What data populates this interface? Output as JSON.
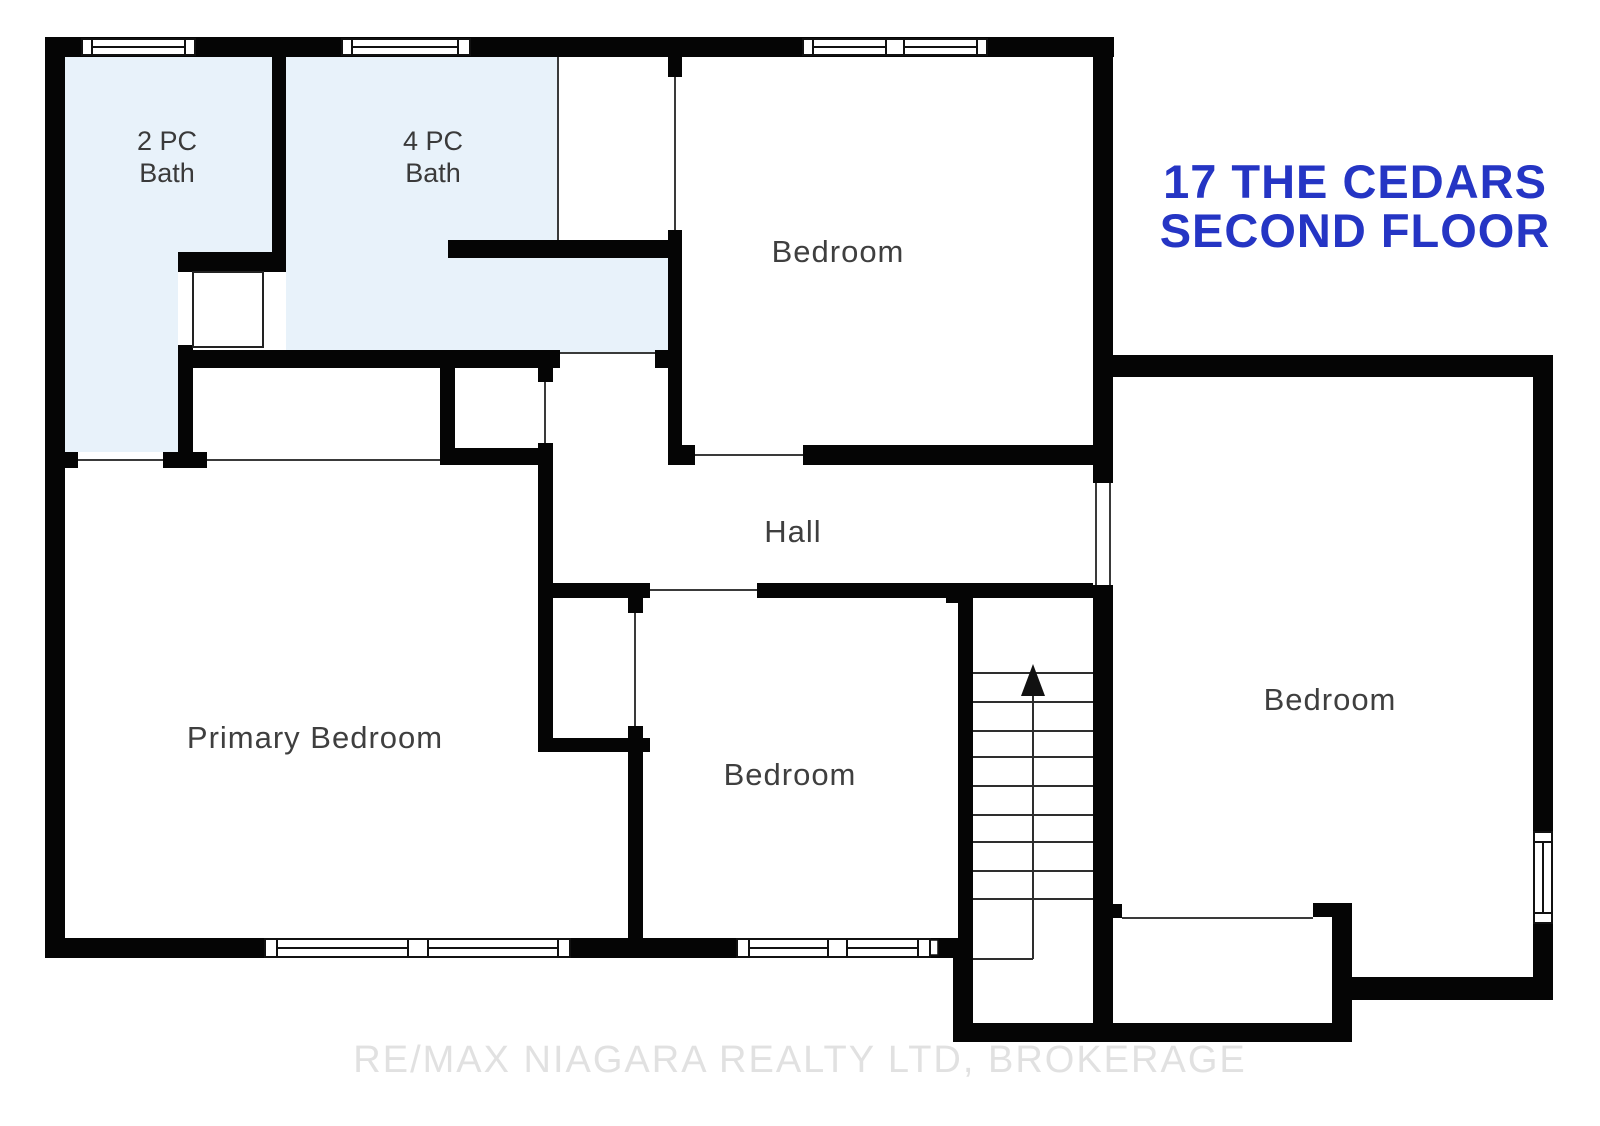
{
  "title": {
    "line1": "17 THE CEDARS",
    "line2": "SECOND FLOOR"
  },
  "watermark": {
    "text": "RE/MAX NIAGARA REALTY LTD, BROKERAGE"
  },
  "rooms": {
    "bath_2pc": {
      "line1": "2 PC",
      "line2": "Bath"
    },
    "bath_4pc": {
      "line1": "4 PC",
      "line2": "Bath"
    },
    "bedroom_top": {
      "label": "Bedroom"
    },
    "hall": {
      "label": "Hall"
    },
    "primary_bedroom": {
      "label": "Primary Bedroom"
    },
    "bedroom_middle": {
      "label": "Bedroom"
    },
    "bedroom_right": {
      "label": "Bedroom"
    }
  },
  "stairs": {
    "direction_icon": "up-arrow"
  },
  "colors": {
    "wall": "#050505",
    "bath_fill": "#e8f2fa",
    "label": "#3f3f3f",
    "title": "#2535c4",
    "watermark": "#e0e0e0"
  }
}
